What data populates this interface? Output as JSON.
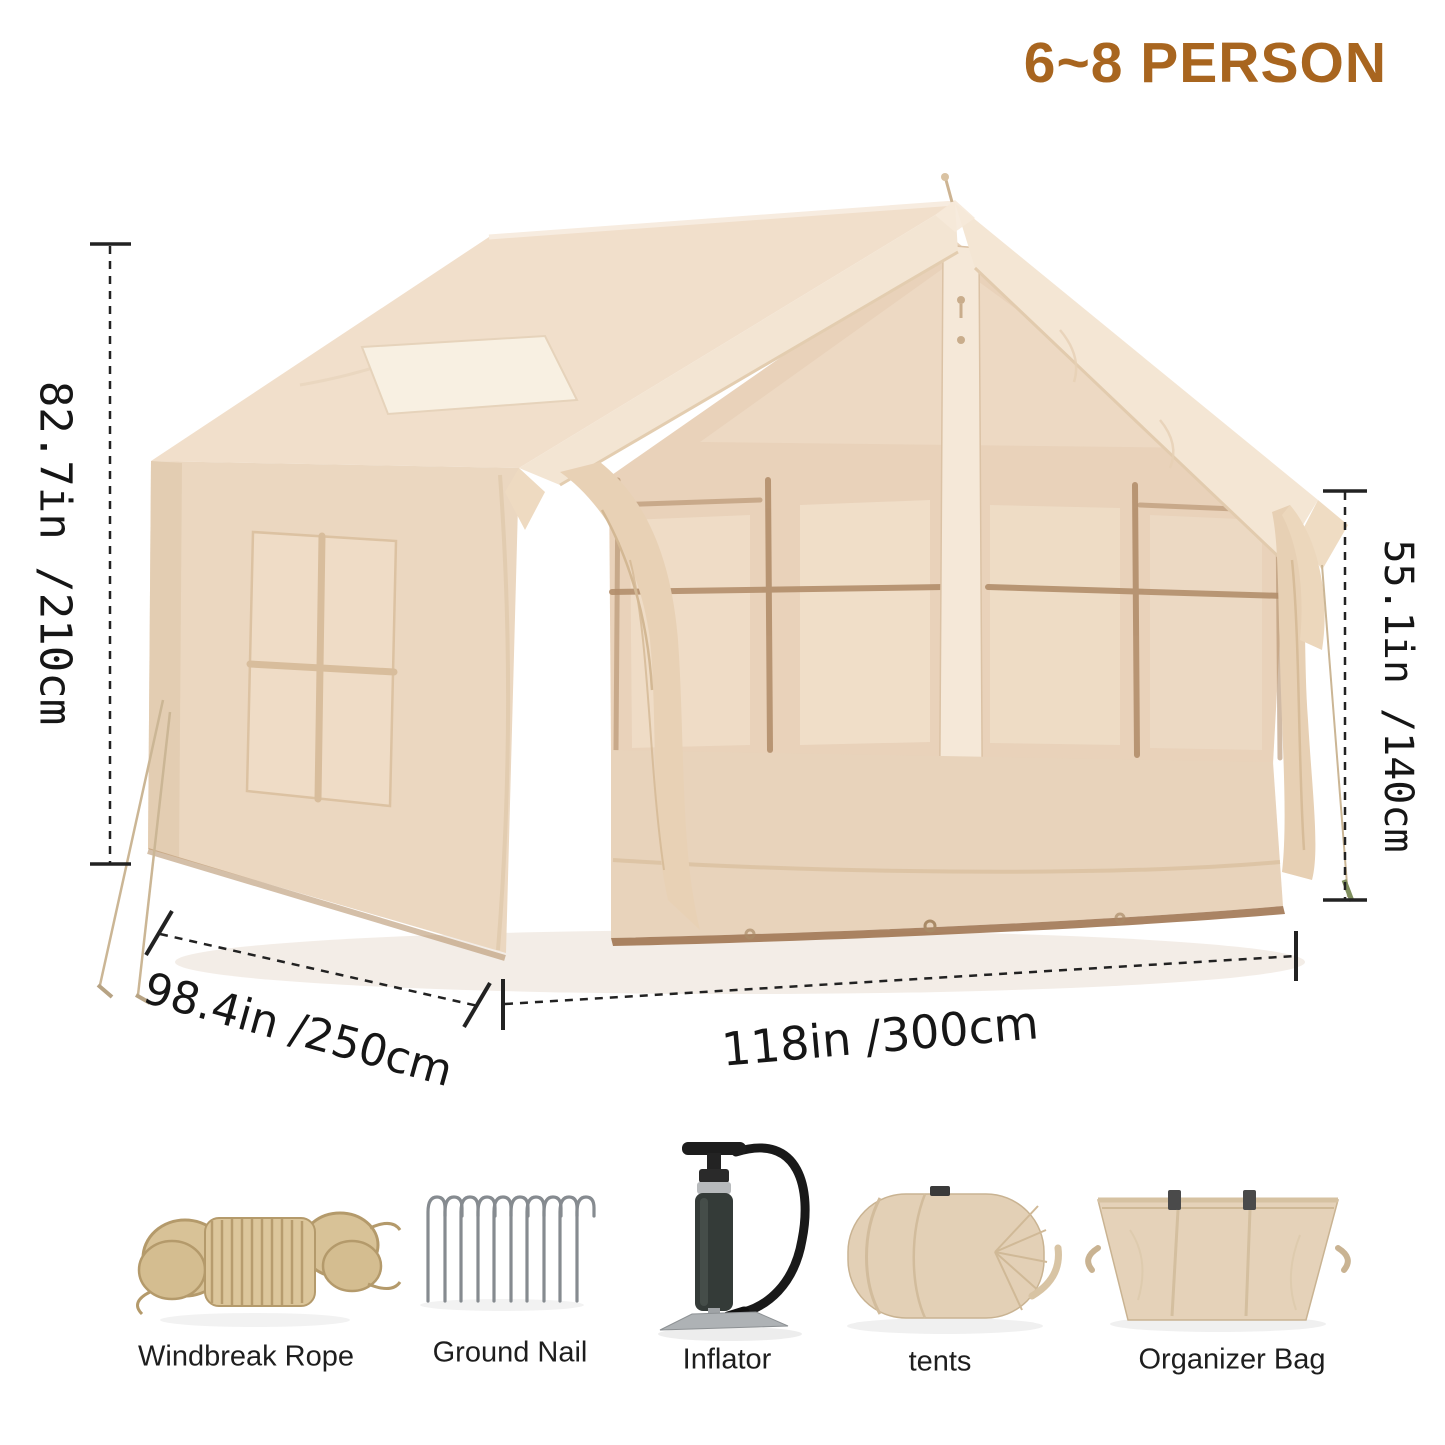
{
  "header": {
    "capacity_label": "6~8 PERSON",
    "accent_color": "#a8651f"
  },
  "tent": {
    "style": "inflatable cabin tent",
    "fabric_color": "#ebd7c0",
    "mesh_color": "#e9d2ba",
    "frame_line_color": "#b28e6b",
    "dimensions": {
      "height_total": "82.7in /210cm",
      "height_wall": "55.1in /140cm",
      "depth": "98.4in /250cm",
      "width": "118in /300cm"
    }
  },
  "accessories": [
    {
      "label": "Windbreak Rope",
      "icon": "rope-coil-icon"
    },
    {
      "label": "Ground Nail",
      "icon": "tent-stakes-icon"
    },
    {
      "label": "Inflator",
      "icon": "air-pump-icon"
    },
    {
      "label": "tents",
      "icon": "tent-bag-icon"
    },
    {
      "label": "Organizer Bag",
      "icon": "organizer-bag-icon"
    }
  ]
}
